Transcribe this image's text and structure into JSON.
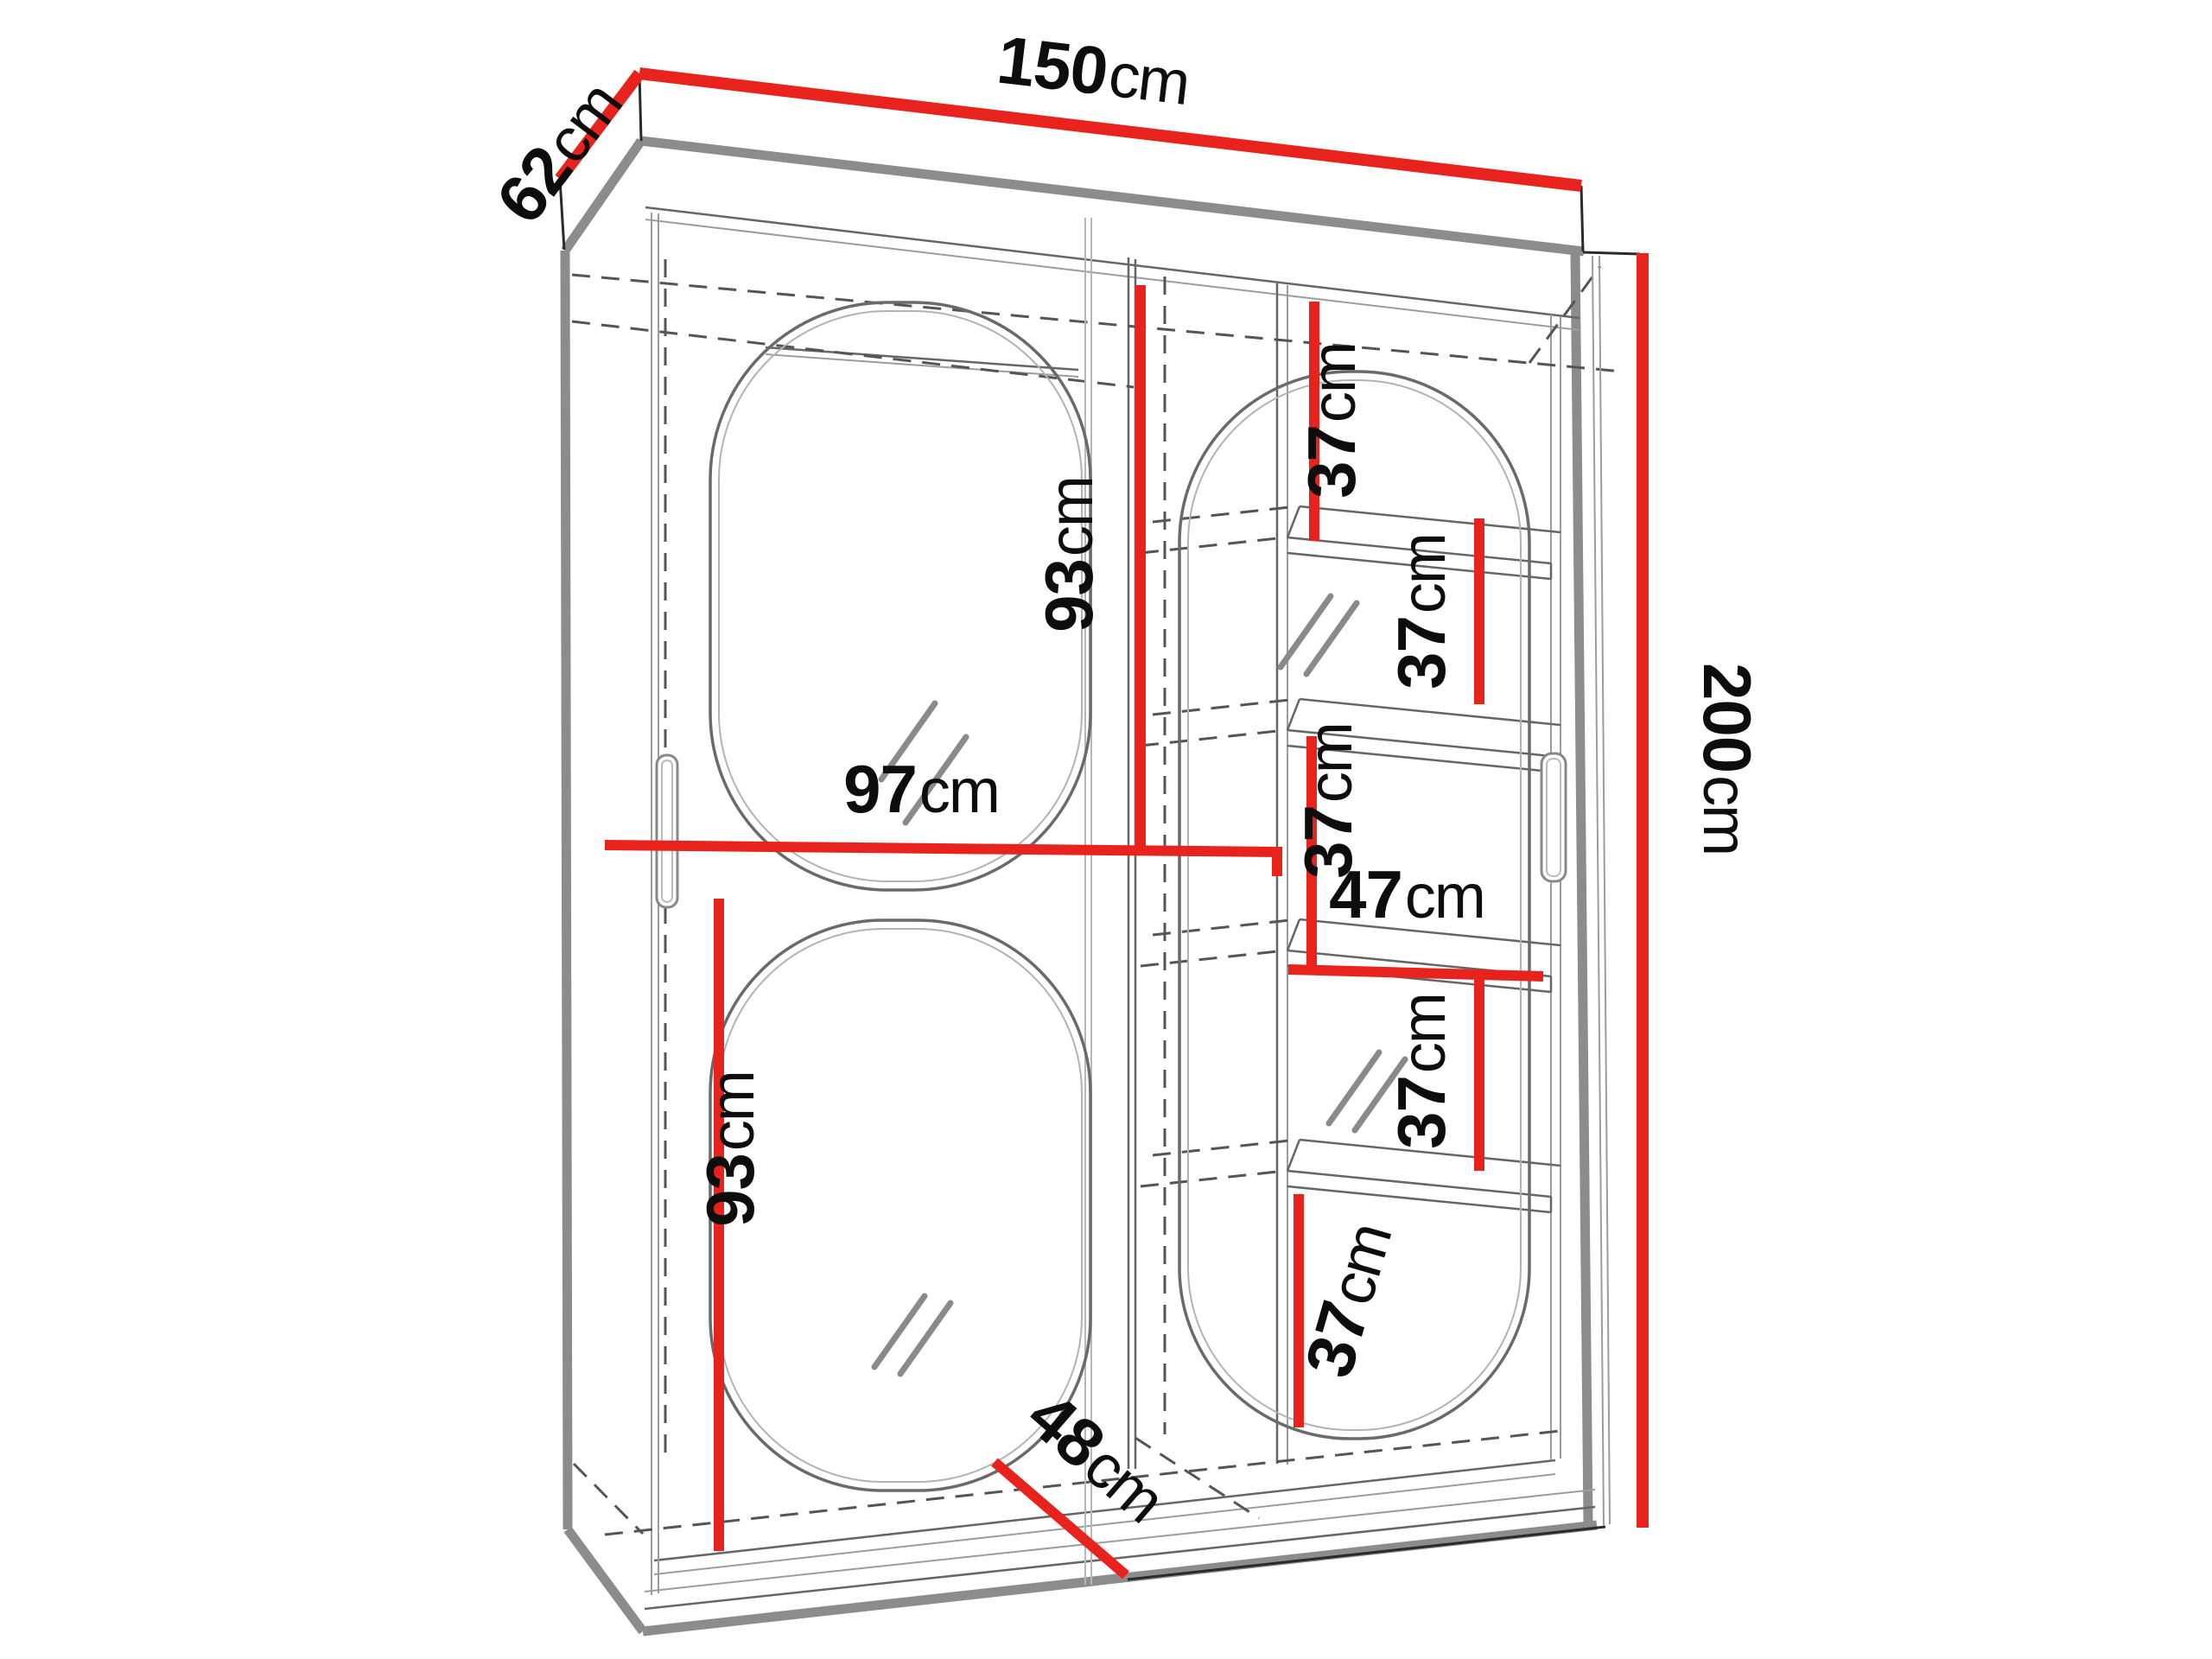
{
  "diagram": {
    "type": "furniture dimension drawing",
    "subject": "two-door sliding wardrobe with mirror ovals and side shelf column",
    "units": "cm",
    "accent_color": "#e8221c",
    "line_color": "#8c8c8c",
    "dimensions": {
      "overall": {
        "width": {
          "value": "150",
          "unit": "cm"
        },
        "depth": {
          "value": "62",
          "unit": "cm"
        },
        "height": {
          "value": "200",
          "unit": "cm"
        }
      },
      "interior": {
        "left_section_width": {
          "value": "97",
          "unit": "cm"
        },
        "left_section_upper_height": {
          "value": "93",
          "unit": "cm"
        },
        "left_section_lower_height": {
          "value": "93",
          "unit": "cm"
        },
        "shelf_section_width": {
          "value": "47",
          "unit": "cm"
        },
        "shelf_gap_1": {
          "value": "37",
          "unit": "cm"
        },
        "shelf_gap_2": {
          "value": "37",
          "unit": "cm"
        },
        "shelf_gap_3": {
          "value": "37",
          "unit": "cm"
        },
        "shelf_gap_4": {
          "value": "37",
          "unit": "cm"
        },
        "shelf_gap_5": {
          "value": "37",
          "unit": "cm"
        },
        "base_diagonal": {
          "value": "48",
          "unit": "cm"
        }
      }
    }
  }
}
